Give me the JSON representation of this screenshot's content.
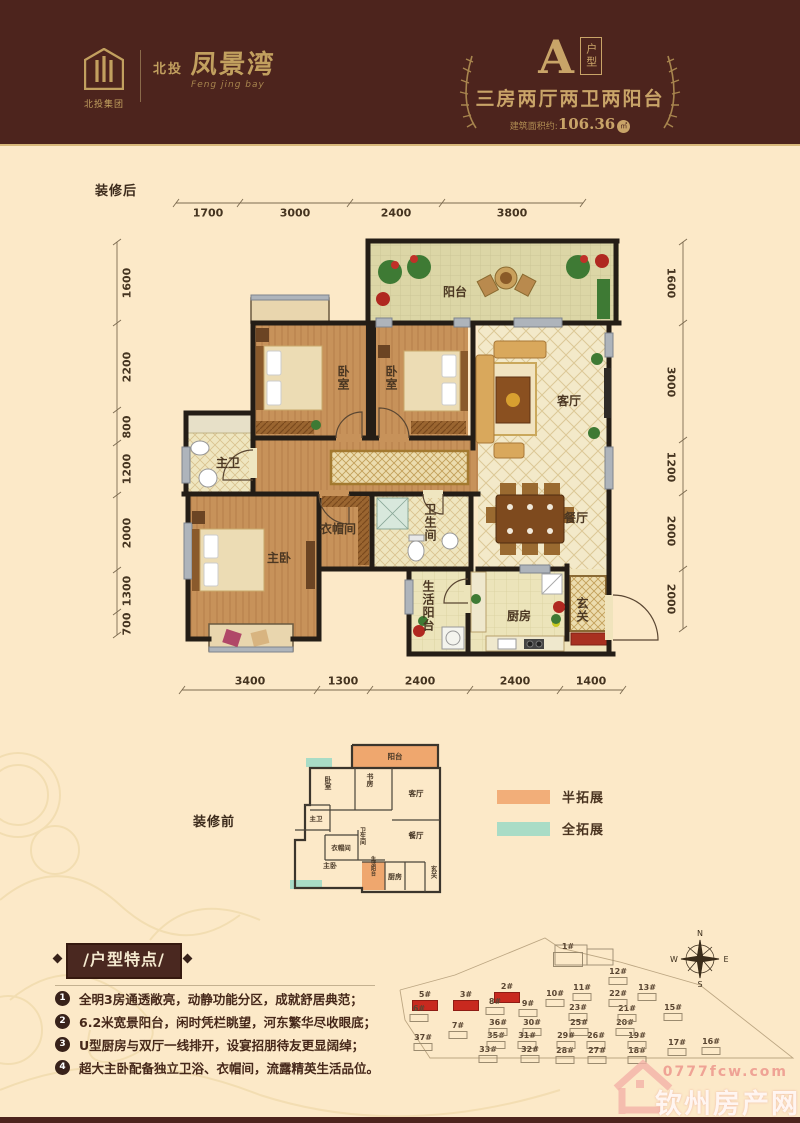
{
  "header": {
    "logo": {
      "group": "北投集团",
      "brand_prefix": "北投",
      "brand": "凤景湾",
      "script": "Feng jing bay"
    },
    "unit": {
      "letter": "A",
      "type": "户型",
      "subtitle": "三房两厅两卫两阳台",
      "area_label": "建筑面积约:",
      "area_value": "106.36",
      "area_unit": "㎡"
    }
  },
  "plan_after": {
    "label": "装修后",
    "dims_top": [
      "1700",
      "3000",
      "2400",
      "3800"
    ],
    "dims_bottom": [
      "3400",
      "1300",
      "2400",
      "2400",
      "1400"
    ],
    "dims_left": [
      "1600",
      "2200",
      "800",
      "1200",
      "2000",
      "1300",
      "700"
    ],
    "dims_right": [
      "1600",
      "3000",
      "1200",
      "2000",
      "2000"
    ],
    "rooms": {
      "balcony": "阳台",
      "bedroom1": "卧室",
      "bedroom2": "卧室",
      "living": "客厅",
      "dining": "餐厅",
      "master_bath": "主卫",
      "cloakroom": "衣帽间",
      "master_bedroom": "主卧",
      "bathroom": "卫生间",
      "service_balcony": "生活阳台",
      "kitchen": "厨房",
      "foyer": "玄关"
    }
  },
  "plan_before": {
    "label": "装修前",
    "rooms": {
      "balcony": "阳台",
      "bedroom": "卧室",
      "study": "书房",
      "living": "客厅",
      "master_bath": "主卫",
      "cloakroom": "衣帽间",
      "bathroom": "卫生间",
      "dining": "餐厅",
      "master_bedroom": "主卧",
      "service_balcony": "生活阳台",
      "kitchen": "厨房",
      "foyer": "玄关"
    }
  },
  "legend": {
    "items": [
      {
        "label": "半拓展",
        "color": "#f2ae79"
      },
      {
        "label": "全拓展",
        "color": "#a9dcc6"
      }
    ]
  },
  "features": {
    "title": "/户型特点/",
    "items": [
      {
        "num": "1",
        "text": "全明3房通透敞亮，动静功能分区，成就舒居典范；"
      },
      {
        "num": "2",
        "text": "6.2米宽景阳台，闲时凭栏眺望，河东繁华尽收眼底；"
      },
      {
        "num": "3",
        "text": "U型厨房与双厅一线排开，设宴招朋待友更显阔绰；"
      },
      {
        "num": "4",
        "text": "超大主卧配备独立卫浴、衣帽间，流露精英生活品位。"
      }
    ]
  },
  "sitemap": {
    "compass": {
      "n": "N",
      "e": "E",
      "s": "S",
      "w": "W"
    },
    "buildings": [
      {
        "label": "1#",
        "x": 173,
        "y": 18,
        "red": false,
        "big": true
      },
      {
        "label": "2#",
        "x": 112,
        "y": 58,
        "red": true
      },
      {
        "label": "3#",
        "x": 71,
        "y": 66,
        "red": true
      },
      {
        "label": "5#",
        "x": 30,
        "y": 66,
        "red": true
      },
      {
        "label": "6#",
        "x": 24,
        "y": 80,
        "red": false
      },
      {
        "label": "7#",
        "x": 63,
        "y": 97,
        "red": false
      },
      {
        "label": "8#",
        "x": 100,
        "y": 73,
        "red": false
      },
      {
        "label": "9#",
        "x": 133,
        "y": 75,
        "red": false
      },
      {
        "label": "10#",
        "x": 160,
        "y": 65,
        "red": false
      },
      {
        "label": "11#",
        "x": 187,
        "y": 59,
        "red": false
      },
      {
        "label": "12#",
        "x": 223,
        "y": 43,
        "red": false
      },
      {
        "label": "13#",
        "x": 252,
        "y": 59,
        "red": false
      },
      {
        "label": "15#",
        "x": 278,
        "y": 79,
        "red": false
      },
      {
        "label": "16#",
        "x": 316,
        "y": 113,
        "red": false
      },
      {
        "label": "17#",
        "x": 282,
        "y": 114,
        "red": false
      },
      {
        "label": "18#",
        "x": 242,
        "y": 122,
        "red": false
      },
      {
        "label": "19#",
        "x": 242,
        "y": 107,
        "red": false
      },
      {
        "label": "20#",
        "x": 230,
        "y": 94,
        "red": false
      },
      {
        "label": "21#",
        "x": 232,
        "y": 80,
        "red": false
      },
      {
        "label": "22#",
        "x": 223,
        "y": 65,
        "red": false
      },
      {
        "label": "23#",
        "x": 183,
        "y": 79,
        "red": false
      },
      {
        "label": "25#",
        "x": 184,
        "y": 94,
        "red": false
      },
      {
        "label": "26#",
        "x": 201,
        "y": 107,
        "red": false
      },
      {
        "label": "27#",
        "x": 202,
        "y": 122,
        "red": false
      },
      {
        "label": "28#",
        "x": 170,
        "y": 122,
        "red": false
      },
      {
        "label": "29#",
        "x": 171,
        "y": 107,
        "red": false
      },
      {
        "label": "30#",
        "x": 137,
        "y": 94,
        "red": false
      },
      {
        "label": "31#",
        "x": 132,
        "y": 107,
        "red": false
      },
      {
        "label": "32#",
        "x": 135,
        "y": 121,
        "red": false
      },
      {
        "label": "33#",
        "x": 93,
        "y": 121,
        "red": false
      },
      {
        "label": "35#",
        "x": 101,
        "y": 107,
        "red": false
      },
      {
        "label": "36#",
        "x": 103,
        "y": 94,
        "red": false
      },
      {
        "label": "37#",
        "x": 28,
        "y": 109,
        "red": false
      }
    ]
  },
  "watermark": {
    "url": "0777fcw.com",
    "site": "钦州房产网"
  }
}
